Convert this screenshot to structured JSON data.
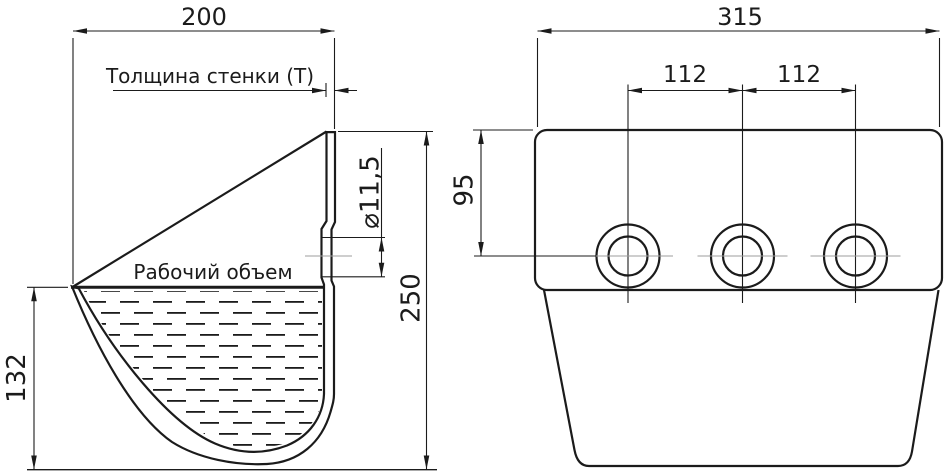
{
  "drawing": {
    "side_view": {
      "width_dim": "200",
      "wall_thickness_label": "Толщина стенки (Т)",
      "working_volume_label": "Рабочий объем",
      "hole_diameter_dim": "⌀11,5",
      "total_height_dim": "250",
      "fill_height_dim": "132"
    },
    "front_view": {
      "width_dim": "315",
      "hole_spacing_left_dim": "112",
      "hole_spacing_right_dim": "112",
      "top_to_hole_dim": "95"
    },
    "colors": {
      "line": "#1b1b1b",
      "centerline": "#9c9c9c",
      "background": "#ffffff"
    }
  }
}
